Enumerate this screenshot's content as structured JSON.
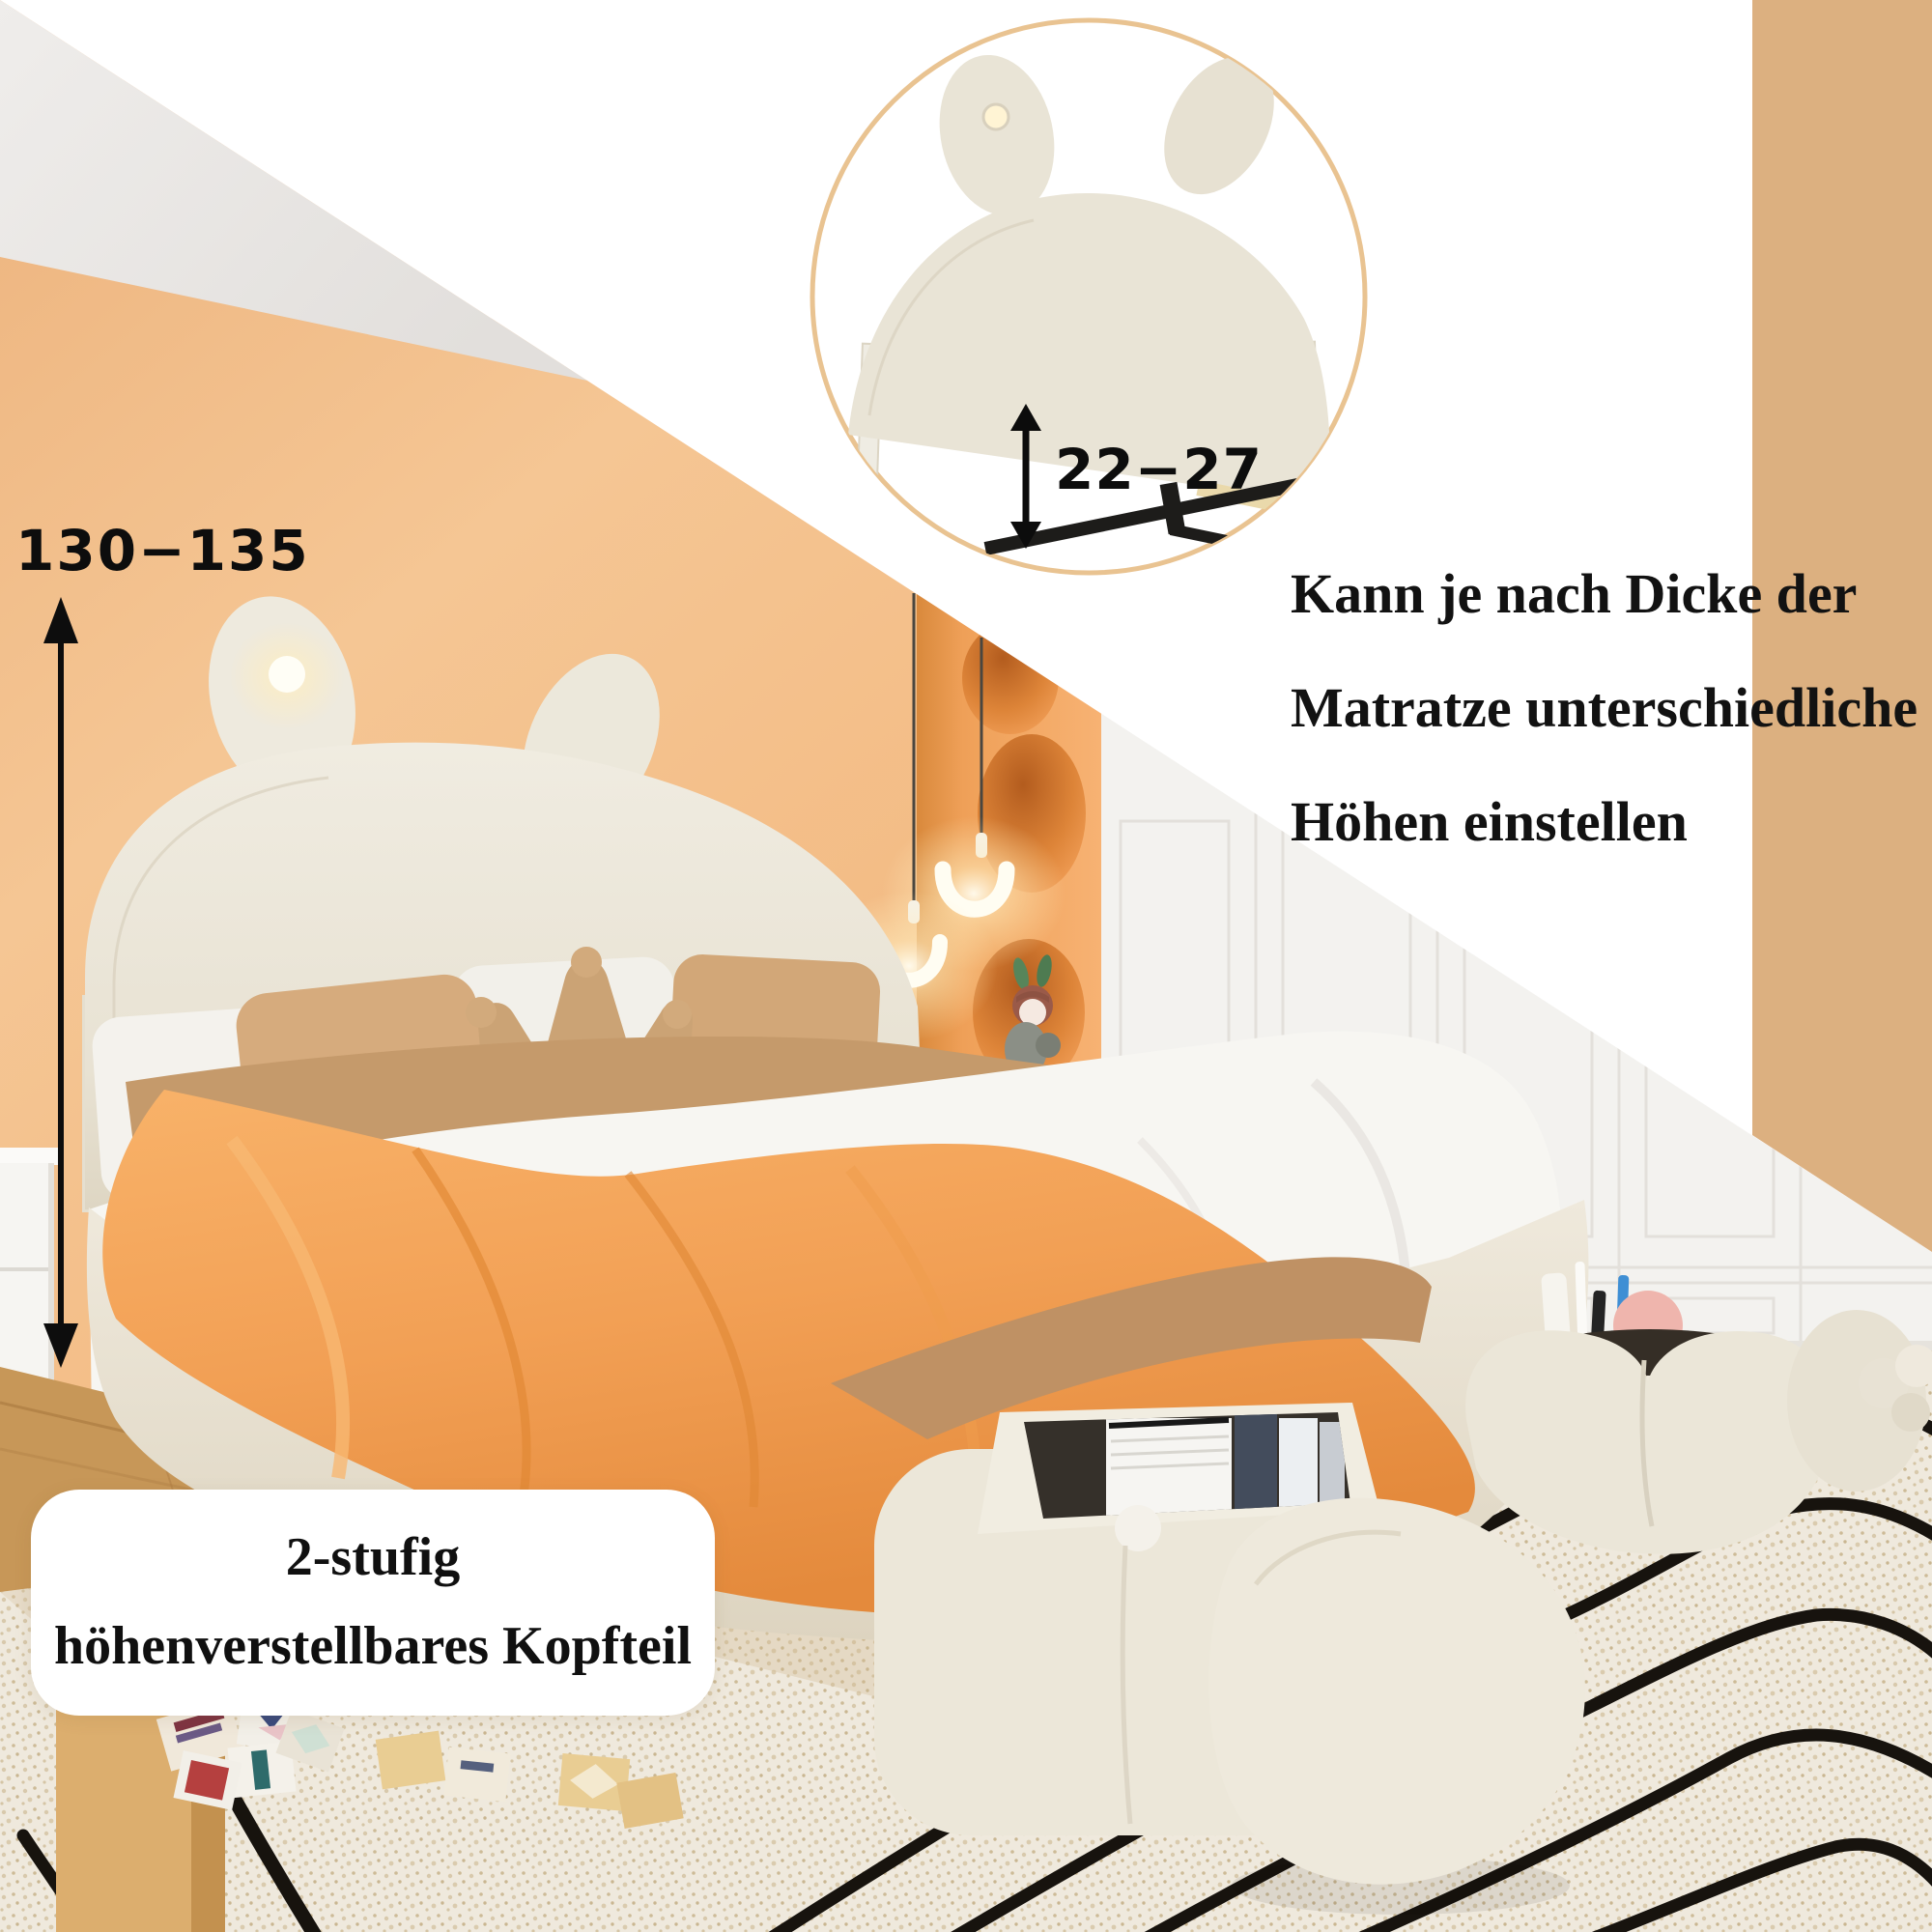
{
  "annotations": {
    "headboard_height": {
      "value": "130−135",
      "unit_hint": "cm-range shown left of bed"
    },
    "inset_height": {
      "value": "22−27",
      "unit_hint": "cm-range shown inside detail circle"
    },
    "note_lines": [
      "Kann je nach Dicke der",
      "Matratze unterschiedliche",
      "Höhen einstellen"
    ],
    "feature_label_lines": [
      "2-stufig",
      "höhenverstellbares Kopfteil"
    ],
    "card_text": "M"
  },
  "icons": {
    "headboard_height_arrow": "double-vertical-arrow",
    "inset_height_arrow": "double-vertical-arrow"
  },
  "colors": {
    "wall_orange": "#f2bd8b",
    "accent_band_tan": "#dcb080",
    "inset_ring": "#e9c391",
    "duvet_orange": "#f2a055",
    "cream_furniture": "#ebe5d7",
    "carpet_base": "#efe9dd",
    "carpet_line_black": "#17130e",
    "text_black": "#0d0d0d"
  }
}
